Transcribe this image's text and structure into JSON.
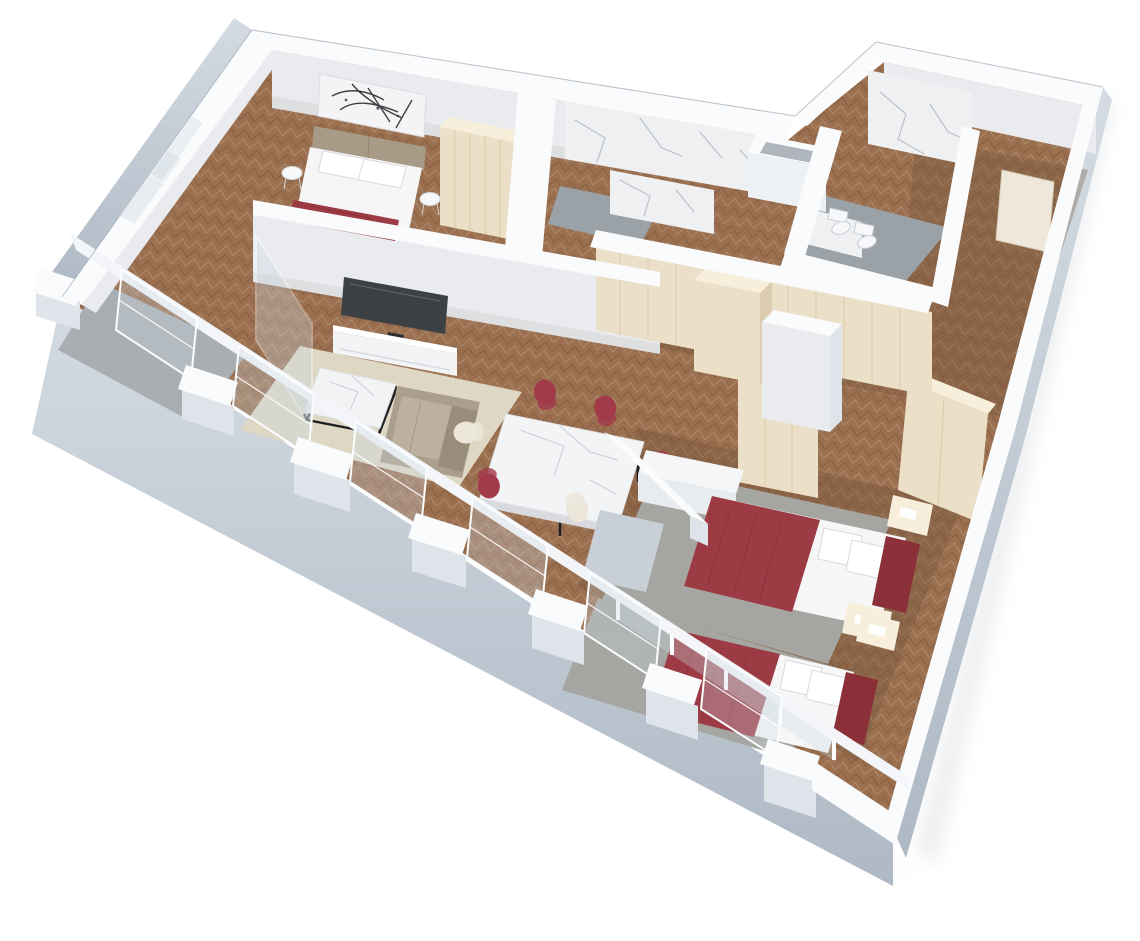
{
  "scene": {
    "kind": "3d-floorplan-cutaway-render",
    "subject": "two-bedroom apartment with living-dining room, two bathrooms, hallway wardrobes and balcony",
    "background": "#ffffff"
  },
  "palette": {
    "wall_top": "#fafbfc",
    "wall_face": "#e9ebee",
    "wall_face_dark": "#dfe4ea",
    "wall_outer_top": "#cdd5dd",
    "wall_outer": "#b9c2cc",
    "floor_wood": "#9a7050",
    "floor_wood_dark": "#6f5138",
    "balcony_floor": "#a9aeb2",
    "bathroom_floor": "#9aa1a7",
    "marble": "#eff0f2",
    "panel_cream": "#ecdfc8",
    "panel_cream_top": "#f7efdc",
    "panel_cream_side": "#dccdb0",
    "rug_cream": "#ded7c4",
    "rug_gray": "#a5a5a1",
    "linen": "#f6f6f7",
    "headboard": "#a79a87",
    "bed_red": "#9c3b44",
    "bed_red_dark": "#8b3039",
    "sofa": "#ab9e8c",
    "sofa_seat": "#bcb0a0",
    "sofa_dark": "#998c7b",
    "tv": "#3c4146",
    "console_white": "#f2f4f6",
    "glass": "#ccd9e2",
    "chair_red": "#a23a4a",
    "chair_cream": "#ece6da",
    "door_beige": "#efe8da",
    "recess_gray": "#c9cfd6",
    "shadow": "#c7ccd2",
    "art_stroke": "#202124",
    "white": "#ffffff"
  },
  "objects": {
    "bedroom_master": [
      "double-bed",
      "abstract-art",
      "wardrobe",
      "round-side-tables"
    ],
    "living_room": [
      "tv",
      "tv-console",
      "coffee-table",
      "sofa",
      "cream-rug"
    ],
    "dining": [
      "marble-dining-table",
      "red-chairs",
      "cream-chairs"
    ],
    "bathroom_1": [
      "marble-walls",
      "shaft-box"
    ],
    "bathroom_2": [
      "marble-wall",
      "toilet",
      "bidet",
      "gray-floor"
    ],
    "hallway": [
      "cream-panel-wardrobe",
      "wood-floor"
    ],
    "bedroom_2": [
      "double-bed-red",
      "wardrobes",
      "dresser",
      "nightstands",
      "gray-rug"
    ],
    "bedroom_3": [
      "double-bed-red",
      "nightstand",
      "gray-rug"
    ],
    "exterior": [
      "tall-windows",
      "glass-balustrades",
      "balcony",
      "pier-caps"
    ]
  }
}
